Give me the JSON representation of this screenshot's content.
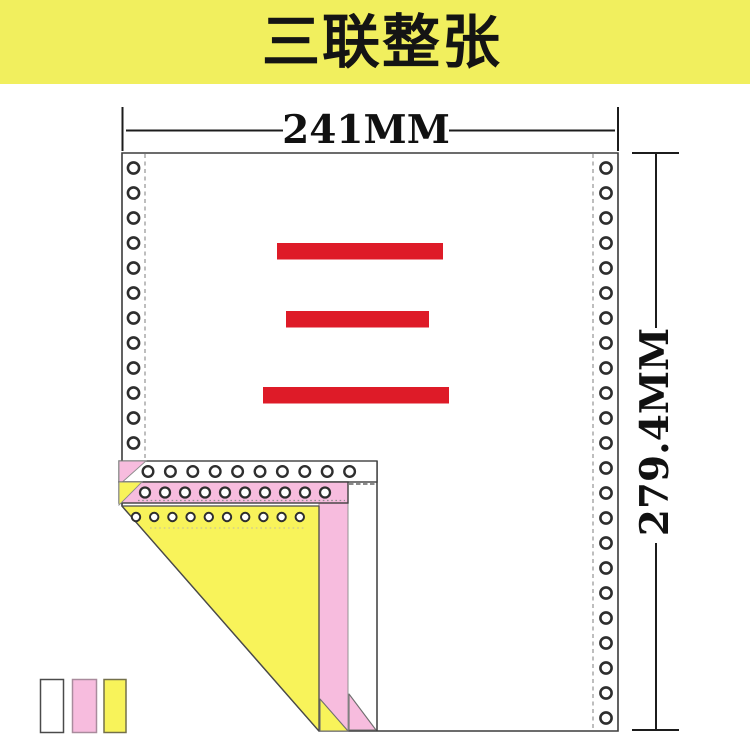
{
  "banner": {
    "title": "三联整张"
  },
  "dimensions": {
    "width_label": "241MM",
    "height_label": "279.4MM"
  },
  "colors": {
    "banner": "#F1EF5E",
    "red": "#DE1B28",
    "pink": "#F7BCDE",
    "yellow": "#F8F35A",
    "paper": "#FFFFFF",
    "line": "#3C3C3C",
    "hole": "#2E2E2E",
    "dash": "#9B9B9B"
  }
}
